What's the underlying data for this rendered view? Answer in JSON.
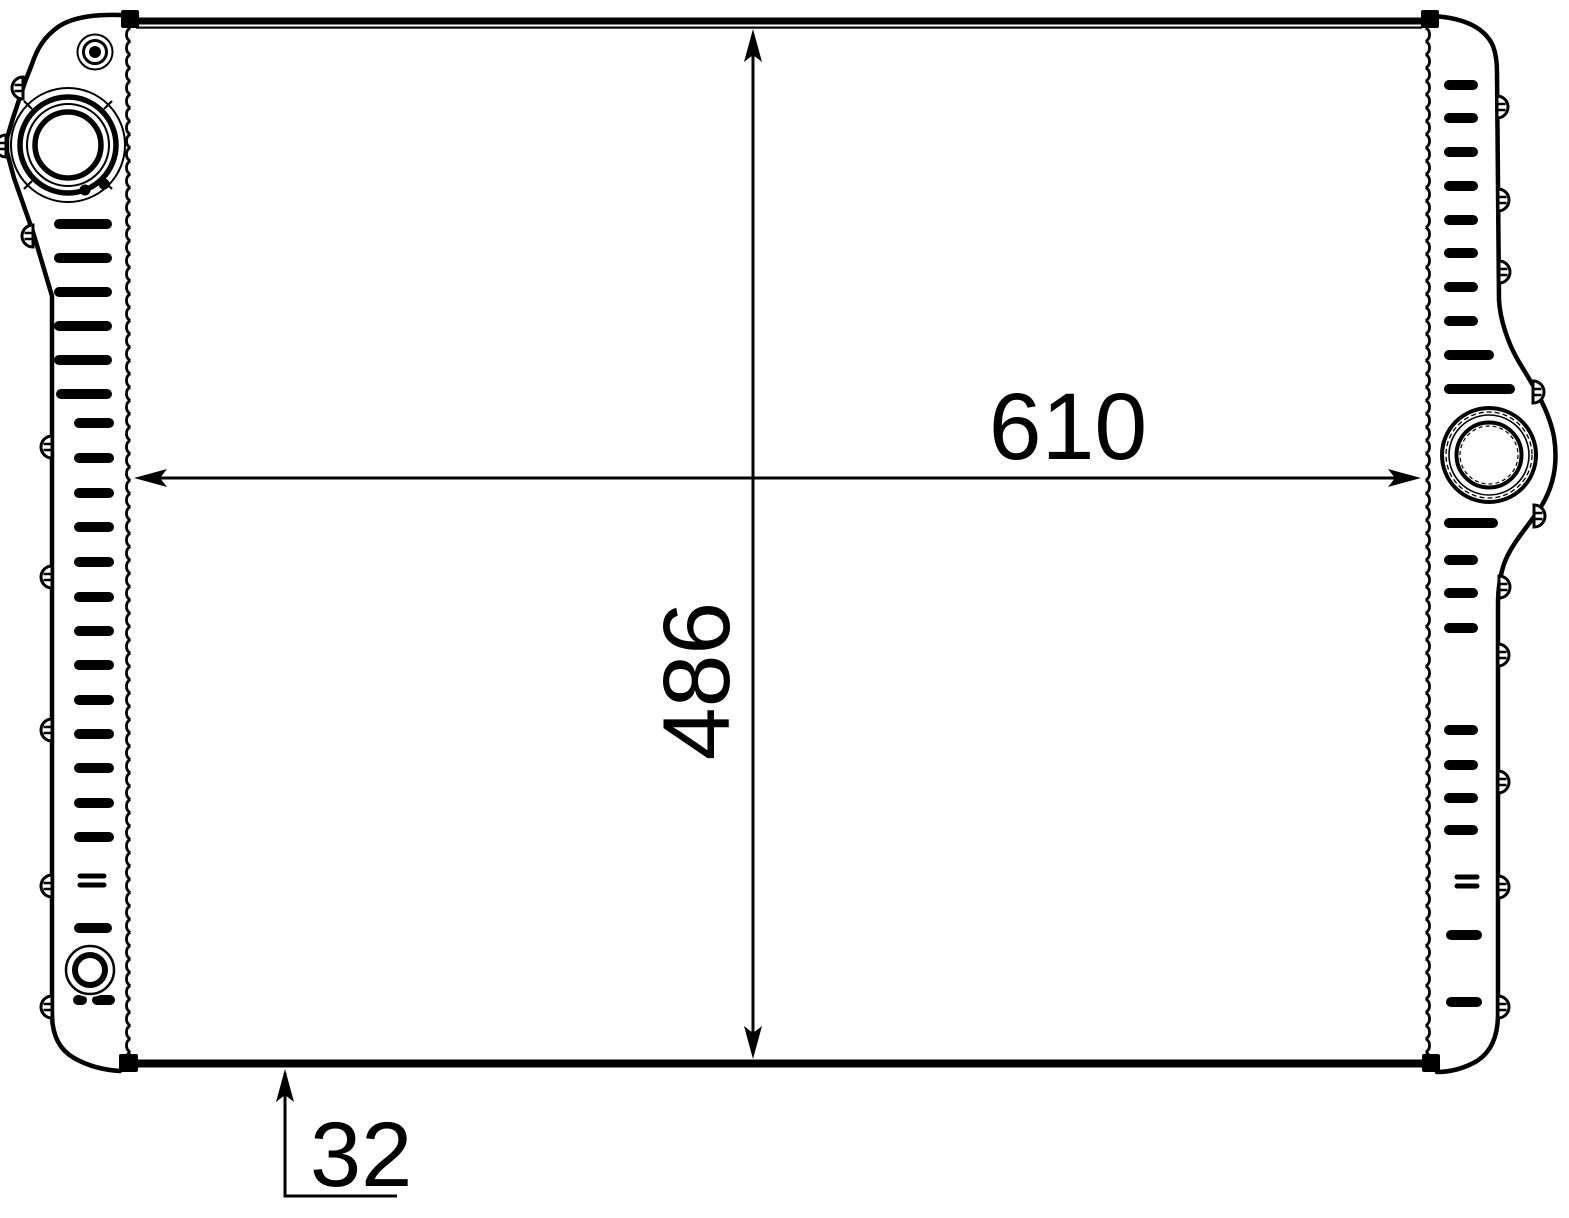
{
  "drawing": {
    "background": "#ffffff",
    "line_color": "#000000",
    "dimensions": {
      "width_mm": "610",
      "height_mm": "486",
      "depth_mm": "32"
    }
  }
}
